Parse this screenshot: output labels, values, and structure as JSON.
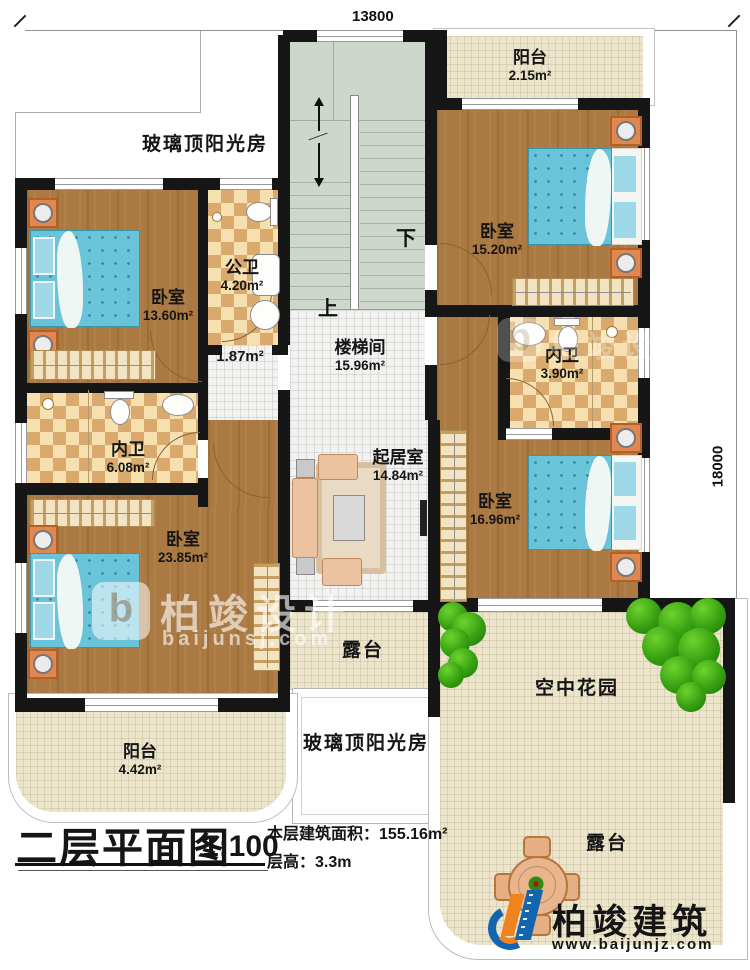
{
  "dimensions": {
    "top": "13800",
    "right": "18000"
  },
  "stairs": {
    "up": "上",
    "down": "下"
  },
  "rooms": {
    "sunroom_top": {
      "name": "玻璃顶阳光房"
    },
    "bedroom_tl": {
      "name": "卧室",
      "area": "13.60m²"
    },
    "public_bath": {
      "name": "公卫",
      "area": "4.20m²"
    },
    "hall": {
      "area": "1.87m²"
    },
    "stairwell": {
      "name": "楼梯间",
      "area": "15.96m²"
    },
    "balcony_tr": {
      "name": "阳台",
      "area": "2.15m²"
    },
    "bedroom_tr": {
      "name": "卧室",
      "area": "15.20m²"
    },
    "inner_bath_r": {
      "name": "内卫",
      "area": "3.90m²"
    },
    "bedroom_r": {
      "name": "卧室",
      "area": "16.96m²"
    },
    "inner_bath_l": {
      "name": "内卫",
      "area": "6.08m²"
    },
    "bedroom_bl": {
      "name": "卧室",
      "area": "23.85m²"
    },
    "living": {
      "name": "起居室",
      "area": "14.84m²"
    },
    "balcony_bl": {
      "name": "阳台",
      "area": "4.42m²"
    },
    "terrace_mid": {
      "name": "露台"
    },
    "sunroom_bottom": {
      "name": "玻璃顶阳光房"
    },
    "sky_garden": {
      "name": "空中花园"
    },
    "terrace_br": {
      "name": "露台"
    }
  },
  "title": {
    "main": "二层平面图",
    "scale": "1:100",
    "area_label": "本层建筑面积：",
    "area_value": "155.16m²",
    "floor_label": "层高：",
    "floor_value": "3.3m"
  },
  "watermark": {
    "brand": "柏竣设计",
    "site": "baijunsj.com"
  },
  "watermark2": {
    "brand": "柏竣设计"
  },
  "footer_logo": {
    "brand": "柏竣建筑",
    "site": "www.baijunjz.com"
  },
  "colors": {
    "wall": "#161616",
    "wood": "#ab7a43",
    "tile_light": "#f6e0b0",
    "tile_dark": "#daa96e",
    "stair": "#cdd7cc",
    "terrace": "#ece5cc",
    "bed": "#69c4d9",
    "tree": "#36a011",
    "furniture": "#e08850",
    "logo_blue": "#1465b0",
    "logo_orange": "#f0831e"
  }
}
